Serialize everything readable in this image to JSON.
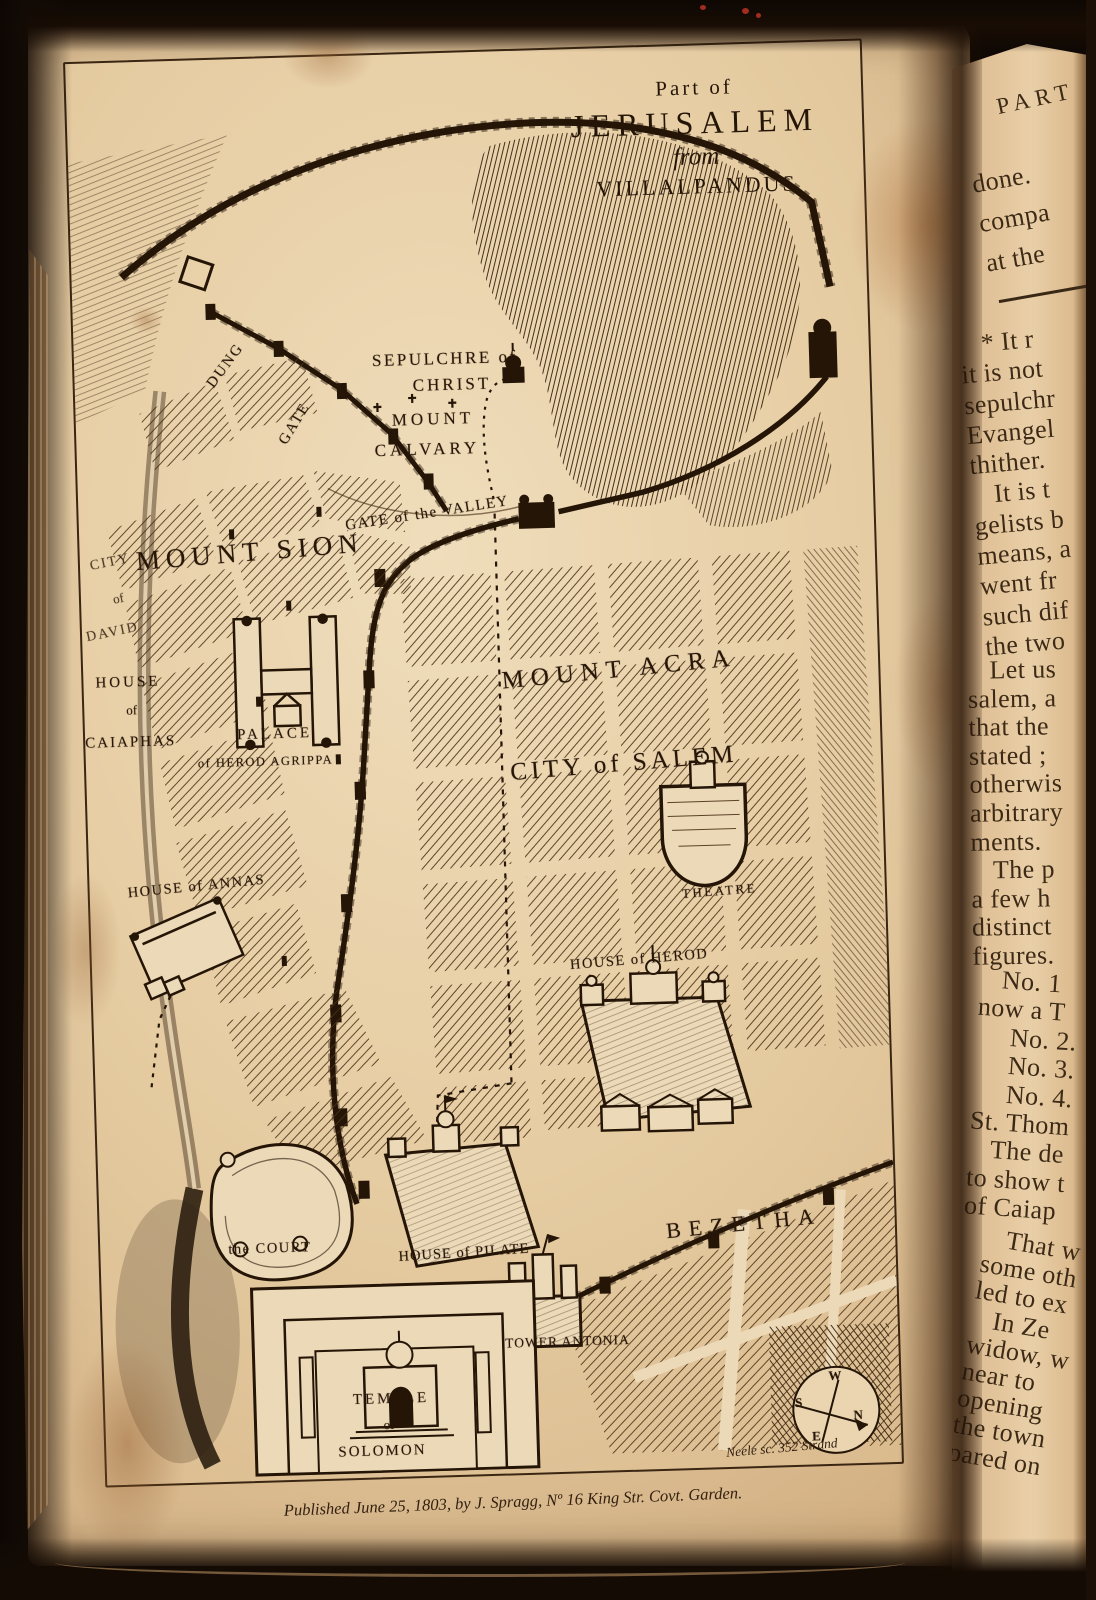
{
  "map": {
    "title": [
      "Part of",
      "JERUSALEM",
      "from",
      "VILLALPANDUS"
    ],
    "labels": {
      "sepulchre_1": "SEPULCHRE of",
      "sepulchre_2": "CHRIST",
      "calvary_1": "MOUNT",
      "calvary_2": "CALVARY",
      "valley_gate": "GATE of the VALLEY",
      "dung": "DUNG",
      "dung_gate": "GATE",
      "mount_sion": "MOUNT SION",
      "david_1": "CITY",
      "david_2": "of",
      "david_3": "DAVID",
      "caiaphas_1": "HOUSE",
      "caiaphas_2": "of",
      "caiaphas_3": "CAIAPHAS",
      "agrippa_1": "PALACE",
      "agrippa_2": "of HEROD AGRIPPA",
      "annas": "HOUSE of ANNAS",
      "acra": "MOUNT ACRA",
      "salem": "CITY of SALEM",
      "theatre": "THEATRE",
      "herod": "HOUSE of HEROD",
      "court": "the COURT",
      "pilate": "HOUSE of PILATE",
      "bezetha": "BEZETHA",
      "antonia": "TOWER ANTONIA",
      "temple_1": "TEMPLE",
      "temple_2": "of",
      "temple_3": "SOLOMON"
    },
    "compass": {
      "w": "W",
      "s": "S",
      "n": "N",
      "e": "E"
    },
    "credits": {
      "engraver": "Neele sc. 352 Strand",
      "publication": "Published June 25, 1803, by J. Spragg, Nº 16 King Str. Covt. Garden."
    }
  },
  "text_page": {
    "header": "PART",
    "lines": [
      "done.",
      "compa",
      "at the",
      "* It r",
      "it is not",
      "sepulchr",
      "Evangel",
      "thither.",
      "It is t",
      "gelists b",
      "means, a",
      "went fr",
      "such dif",
      "the two",
      "Let us",
      "salem, a",
      "that the",
      "stated ;",
      "otherwis",
      "arbitrary",
      "ments.",
      "The p",
      "a few h",
      "distinct",
      "figures.",
      "No. 1",
      "now a T",
      "No. 2.",
      "No. 3.",
      "No. 4.",
      "St. Thom",
      "The de",
      "to show t",
      "of Caiap",
      "That w",
      "some oth",
      "led to ex",
      "In Ze",
      "widow, w",
      "near to",
      "opening",
      "the town",
      "pared on"
    ]
  }
}
